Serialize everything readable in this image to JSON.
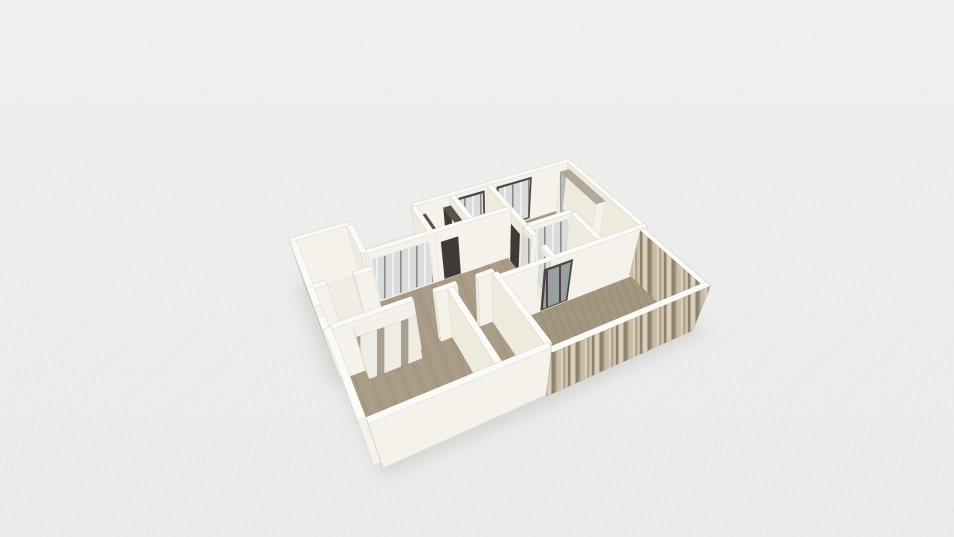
{
  "view": {
    "width": 954,
    "height": 537
  },
  "scene": {
    "background": "#ededec",
    "grid_line": "#787878"
  },
  "camera": {
    "pos": [
      0,
      -18.2,
      15.8
    ],
    "target": [
      7.0,
      -4.6,
      0.4
    ],
    "focal": 520,
    "cx": 498,
    "cy": 295
  },
  "materials": {
    "wallTop": "#fbfaf7",
    "wallS": "#f5f2ec",
    "wallN": "#f0ece3",
    "wallW": "#efeade",
    "wallE": "#e8e3d8",
    "tile": "#f0ede6",
    "wood": "#a99b86",
    "woodDark": "#93866f",
    "woodBal": "#a49780",
    "woodBalDark": "#8a7e6c",
    "doorDark": "#3f3a35",
    "darkTop": "#58534b",
    "frameDark": "#4a4540",
    "glass": "#d8dcdd",
    "glassBar": "#8e8b86",
    "paneGray": "#9aa0a2",
    "wardrobeWhite": "#edebe4",
    "wardrobeGray": "#b7bbbc",
    "wardrobeTop": "#b1a89b",
    "wardrobeCream": "#efece3",
    "wardrobeGap": "#a89f8f",
    "railBase": "#dcdcd8",
    "railSlat": "#f8f8f6",
    "railTop": "#f7f7f5",
    "slat1": "#b2a48c",
    "slat2": "#c9bfa8",
    "slat3": "#8f8370",
    "slat4": "#d8d0bd",
    "slab": "#f5f3ed",
    "shadow": "#c6c4bf"
  },
  "geometry": {
    "shadow": [
      [
        -0.4,
        -0.3
      ],
      [
        13.6,
        -0.3
      ],
      [
        13.6,
        9.95
      ],
      [
        6.3,
        10.0
      ],
      [
        0.2,
        9.85
      ],
      [
        -0.1,
        5.6
      ],
      [
        -0.4,
        5.5
      ]
    ],
    "slab": [
      [
        0,
        0
      ],
      [
        13.2,
        0
      ],
      [
        13.2,
        9.6
      ],
      [
        6.4,
        9.6
      ],
      [
        6.4,
        9.54
      ],
      [
        0.3,
        9.54
      ],
      [
        0.3,
        9.3
      ],
      [
        0.06,
        9.3
      ],
      [
        0.06,
        5.4
      ],
      [
        0,
        5.4
      ]
    ],
    "floors": [
      [
        "floor-winroom",
        0,
        0,
        2.4,
        3.2,
        "tile"
      ],
      [
        "floor-north-balcony",
        2.4,
        0,
        5.2,
        2.2,
        "wood"
      ],
      [
        "floor-laundry",
        5.2,
        0,
        7.0,
        2.2,
        "tile"
      ],
      [
        "floor-bath-north",
        7.0,
        0,
        8.8,
        2.2,
        "tile"
      ],
      [
        "floor-bedroom-ne",
        8.8,
        0,
        13.2,
        3.6,
        "wood"
      ],
      [
        "floor-bedroom-ne-south",
        11.0,
        3.6,
        13.2,
        5.8,
        "wood"
      ],
      [
        "floor-living",
        2.4,
        2.2,
        8.8,
        5.8,
        "wood"
      ],
      [
        "floor-living-west",
        0,
        3.2,
        2.4,
        5.4,
        "wood"
      ],
      [
        "floor-closet",
        8.8,
        3.6,
        11.0,
        5.8,
        "tile"
      ],
      [
        "floor-bedroom-sw",
        0.3,
        5.4,
        4.6,
        9.3,
        "wood"
      ],
      [
        "floor-hall-south",
        4.6,
        5.4,
        6.4,
        9.3,
        "wood"
      ],
      [
        "floor-terrace",
        6.4,
        5.8,
        13.2,
        9.6,
        "woodBal"
      ]
    ],
    "solids": [
      [
        "wall-n-winroom",
        0,
        0,
        2.4,
        0.24,
        2.7,
        "wall"
      ],
      [
        "wall-n-laundry-bath",
        5.2,
        0,
        8.8,
        0.24,
        2.7,
        "wall"
      ],
      [
        "wall-n-bedroom-ne",
        8.8,
        0,
        13.2,
        0.24,
        2.7,
        "wall"
      ],
      [
        "wall-w-winroom",
        0,
        0.24,
        0.24,
        3.2,
        2.7,
        "wall"
      ],
      [
        "wall-w-mid-a",
        0,
        3.2,
        0.24,
        4.2,
        2.7,
        "wall"
      ],
      [
        "wall-w-mid-b",
        0,
        4.8,
        0.24,
        5.4,
        2.7,
        "wall"
      ],
      [
        "wall-w-bedroom-sw",
        0.06,
        5.4,
        0.3,
        9.3,
        2.7,
        "wall"
      ],
      [
        "wall-s-bedroom-sw",
        0.3,
        9.3,
        6.4,
        9.54,
        2.7,
        "wall"
      ],
      [
        "parapet-s-terrace",
        6.4,
        9.36,
        13.2,
        9.6,
        2.5,
        "slat"
      ],
      [
        "parapet-e-terrace",
        12.96,
        5.8,
        13.2,
        9.6,
        2.5,
        "slat"
      ],
      [
        "wall-e-bedroom-ne",
        12.96,
        0.24,
        13.2,
        5.8,
        2.7,
        "wall"
      ],
      [
        "wall-s-winroom-a",
        0,
        3.08,
        0.7,
        3.32,
        2.7,
        "wall"
      ],
      [
        "wall-s-winroom-b",
        1.7,
        3.08,
        2.4,
        3.32,
        2.7,
        "wall"
      ],
      [
        "wall-winroom-balcony",
        2.28,
        0.24,
        2.52,
        2.2,
        2.7,
        "wall"
      ],
      [
        "wall-balcony-laundry",
        5.08,
        0.24,
        5.32,
        2.2,
        2.7,
        "wall"
      ],
      [
        "wall-laundry-bath",
        6.88,
        0.24,
        7.12,
        2.2,
        2.7,
        "wall"
      ],
      [
        "wall-living-north",
        2.4,
        2.08,
        8.8,
        2.32,
        2.7,
        "wall"
      ],
      [
        "wall-living-bedroom-ne",
        8.68,
        0.24,
        8.92,
        3.6,
        2.7,
        "wall"
      ],
      [
        "wall-closet-w-a",
        8.68,
        3.6,
        8.92,
        4.3,
        2.7,
        "wall"
      ],
      [
        "wall-closet-w-b",
        8.68,
        5.0,
        8.92,
        5.8,
        2.7,
        "wall"
      ],
      [
        "wall-closet-n",
        8.92,
        3.48,
        11.0,
        3.72,
        2.7,
        "wall"
      ],
      [
        "wall-closet-e",
        10.88,
        3.72,
        11.12,
        5.8,
        2.7,
        "wall"
      ],
      [
        "wall-living-south-a",
        0.3,
        5.28,
        3.2,
        5.52,
        2.7,
        "wall"
      ],
      [
        "wall-living-south-b",
        4.0,
        5.28,
        4.9,
        5.52,
        2.7,
        "wall"
      ],
      [
        "wall-living-south-c",
        5.7,
        5.28,
        6.4,
        5.52,
        2.7,
        "wall"
      ],
      [
        "wall-bedroomsw-hall",
        4.48,
        5.52,
        4.72,
        9.3,
        2.7,
        "wall"
      ],
      [
        "wall-hall-terrace",
        6.28,
        5.52,
        6.52,
        9.36,
        2.7,
        "wall"
      ],
      [
        "wall-terrace-north",
        6.4,
        5.68,
        13.2,
        5.92,
        2.7,
        "wall"
      ],
      [
        "railing-north-balcony",
        2.4,
        0,
        5.2,
        0.12,
        1.06,
        "rail"
      ],
      [
        "wardrobe-bedroom-ne",
        12.45,
        0.45,
        12.95,
        3.4,
        2.45,
        "light",
        {
          "W": "pat-wardrobe",
          "T": "#b1a89b"
        }
      ],
      [
        "wardrobe-bedroom-sw",
        0.95,
        5.54,
        3.05,
        5.96,
        2.4,
        "light",
        {
          "S": "pat-cream",
          "T": "#f3f1ea"
        }
      ],
      [
        "cabinet-laundry-east",
        6.5,
        0.3,
        6.86,
        1.7,
        2.25,
        "dark"
      ],
      [
        "shelf-laundry-west",
        5.34,
        0.3,
        5.66,
        1.5,
        2.2,
        "dark"
      ],
      [
        "vanity-bath-north",
        7.22,
        0.26,
        8.45,
        0.85,
        1.02,
        "dark"
      ]
    ],
    "details": [
      [
        "window-winroom-frame",
        "x",
        -0.02,
        0.62,
        0.8,
        2.02,
        2.3,
        "frameDark"
      ],
      [
        "window-winroom-blinds",
        "x",
        -0.045,
        0.74,
        0.92,
        1.9,
        2.18,
        "pat-blind"
      ],
      [
        "glassdoor-bath-frame",
        "y",
        0.27,
        7.2,
        0.12,
        8.55,
        2.5,
        "frameDark"
      ],
      [
        "glassdoor-bath-pane",
        "y",
        0.295,
        7.3,
        0.22,
        8.45,
        2.4,
        "pat-glass"
      ],
      [
        "glassdoor-bedroom-ne-frame",
        "y",
        0.27,
        9.15,
        0.12,
        11.0,
        2.5,
        "frameDark"
      ],
      [
        "glassdoor-bedroom-ne-pane",
        "y",
        0.295,
        9.25,
        0.22,
        10.9,
        2.4,
        "pat-glass"
      ],
      [
        "glazing-balcony-living",
        "y",
        2.34,
        2.62,
        0.12,
        4.98,
        2.35,
        "pat-glass"
      ],
      [
        "door-laundry",
        "y",
        2.34,
        5.52,
        0.06,
        6.3,
        2.16,
        "doorDark"
      ],
      [
        "door-bath-north",
        "y",
        2.34,
        7.28,
        0.06,
        8.06,
        2.16,
        "doorDark"
      ],
      [
        "door-bedroom-ne",
        "x",
        8.66,
        2.58,
        0.06,
        3.38,
        2.16,
        "doorDark"
      ],
      [
        "glasswall-closet-w-a",
        "x",
        8.66,
        3.68,
        0.7,
        4.28,
        2.45,
        "pat-glass"
      ],
      [
        "glasswall-closet-w-b",
        "x",
        8.66,
        5.0,
        0.7,
        5.78,
        2.45,
        "pat-glass"
      ],
      [
        "glasswall-closet-n",
        "y",
        3.745,
        9.05,
        0.6,
        10.85,
        2.45,
        "pat-glass"
      ],
      [
        "slider-terrace-frame",
        "y",
        5.945,
        8.28,
        0.08,
        9.6,
        2.4,
        "frameDark"
      ],
      [
        "slider-terrace-pane",
        "y",
        5.965,
        8.38,
        0.18,
        9.5,
        2.3,
        "pat-paneDark"
      ],
      [
        "window-bedroom-ne-terrace",
        "y",
        5.945,
        11.3,
        0.3,
        12.7,
        2.3,
        "pat-glass"
      ],
      [
        "door-bedroom-sw",
        "x",
        4.46,
        5.88,
        0.06,
        6.72,
        2.12,
        "doorDark"
      ],
      [
        "door-hall-south",
        "y",
        9.28,
        4.92,
        0.06,
        5.68,
        2.12,
        "doorDark"
      ]
    ]
  }
}
